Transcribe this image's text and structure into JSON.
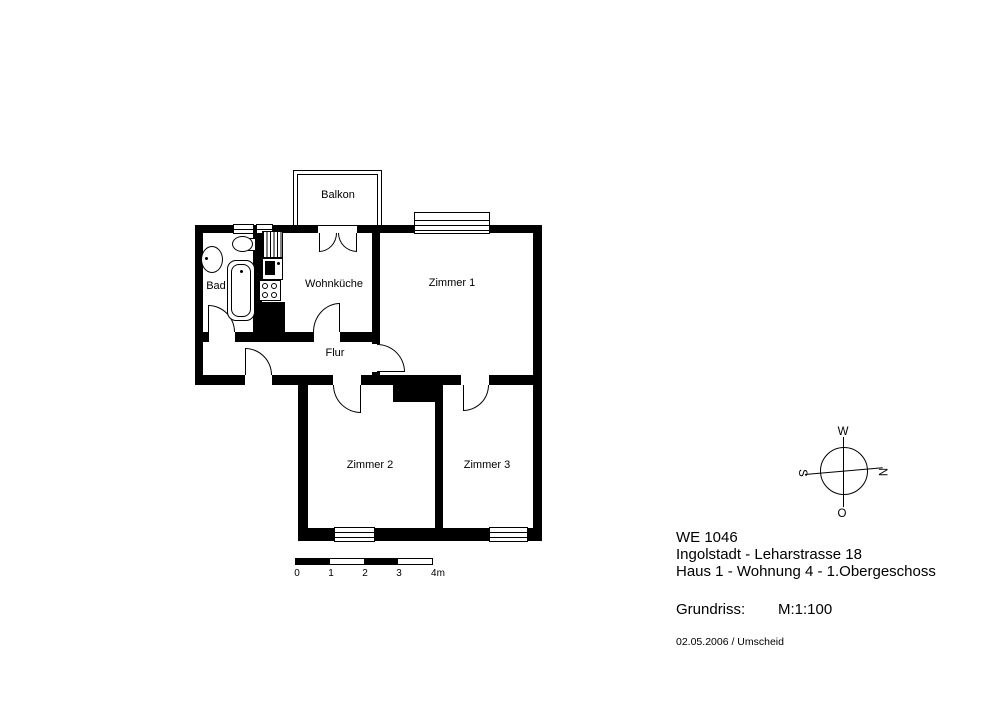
{
  "floorplan": {
    "rooms": {
      "balkon": "Balkon",
      "bad": "Bad",
      "wohnkueche": "Wohnküche",
      "zimmer1": "Zimmer 1",
      "flur": "Flur",
      "zimmer2": "Zimmer 2",
      "zimmer3": "Zimmer 3"
    }
  },
  "compass": {
    "top": "W",
    "right": "N",
    "bottom": "O",
    "left": "S"
  },
  "scale_bar": {
    "labels": [
      "0",
      "1",
      "2",
      "3",
      "4m"
    ]
  },
  "info": {
    "line1": "WE 1046",
    "line2": "Ingolstadt - Leharstrasse 18",
    "line3": "Haus 1 - Wohnung 4 -  1.Obergeschoss",
    "plan_type_label": "Grundriss:",
    "scale_label": "M:1:100",
    "date_author": "02.05.2006 / Umscheid"
  },
  "colors": {
    "wall": "#000000",
    "background": "#ffffff"
  }
}
